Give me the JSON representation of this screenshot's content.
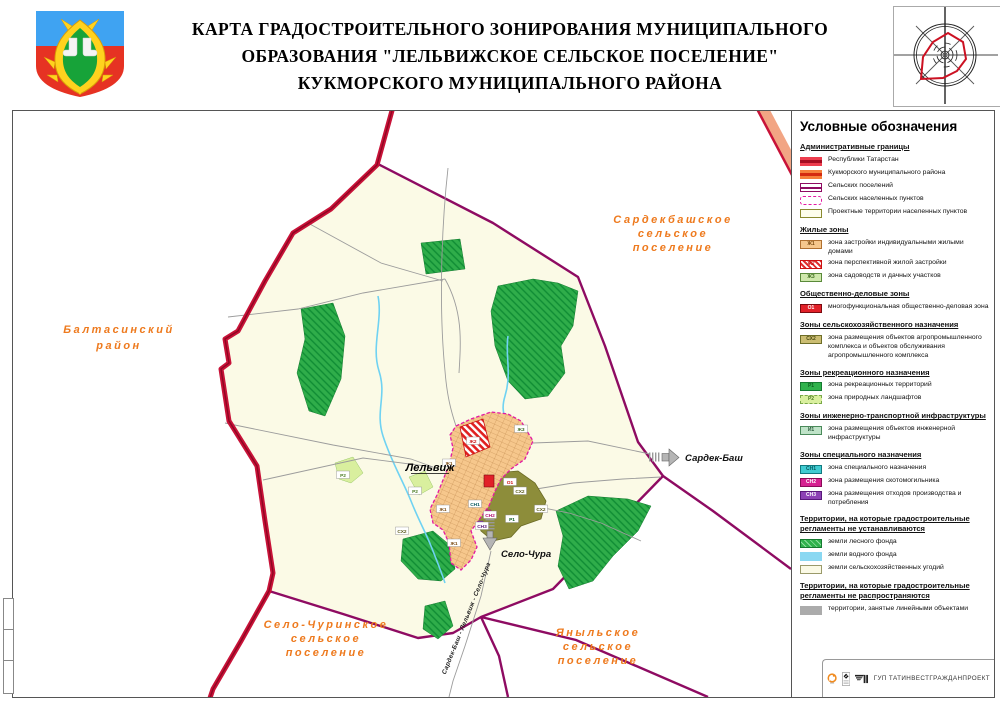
{
  "header": {
    "title_lines": [
      "КАРТА ГРАДОСТРОИТЕЛЬНОГО ЗОНИРОВАНИЯ МУНИЦИПАЛЬНОГО",
      "ОБРАЗОВАНИЯ \"ЛЕЛЬВИЖСКОЕ СЕЛЬСКОЕ ПОСЕЛЕНИЕ\"",
      "КУКМОРСКОГО МУНИЦИПАЛЬНОГО РАЙОНА"
    ]
  },
  "map": {
    "neighbor_labels": {
      "sardekbash": {
        "lines": [
          "Сардекбашское",
          "сельское",
          "поселение"
        ]
      },
      "baltasinsky": {
        "lines": [
          "Балтасинский",
          "район"
        ]
      },
      "selo_churinskoe": {
        "lines": [
          "Село-Чуринское",
          "сельское",
          "поселение"
        ]
      },
      "yanylskoe": {
        "lines": [
          "Яныльское",
          "сельское",
          "поселение"
        ]
      }
    },
    "village_label": "Лельвиж",
    "arrow_labels": {
      "sardek_bash": "Сардек-Баш",
      "selo_chura": "Село-Чура"
    },
    "road_label": "Сардек-Баш - Лельвиж - Село-Чура",
    "zone_codes": {
      "zh1": "Ж1",
      "zh2": "Ж2",
      "zh3": "Ж3",
      "o1": "О1",
      "sh2": "СХ2",
      "r1": "Р1",
      "r2": "Р2",
      "i1": "И1",
      "sn1": "СН1",
      "sn2": "СН2",
      "sn3": "СН3"
    },
    "colors": {
      "neighbor_label": "#ee7a1e",
      "republic_border": "#c81238",
      "settlement_border": "#8e0b62",
      "village_border": "#e319a2",
      "village_fill": "#f6c78c",
      "forest": "#2fad4a",
      "water": "#6fd2f2",
      "farmland": "#fbfae6",
      "agro_zone": "#8d8d3a",
      "business_zone": "#e12028"
    }
  },
  "legend": {
    "title": "Условные обозначения",
    "sections": [
      {
        "title": "Административные границы",
        "items": [
          {
            "swatch": "band",
            "fill": "#ed3d4e",
            "core": "#a50d22",
            "label": "Республики Татарстан"
          },
          {
            "swatch": "band",
            "fill": "#f5803c",
            "core": "#d42a10",
            "label": "Кукморского муниципального района"
          },
          {
            "swatch": "plines",
            "color": "#8e0b62",
            "label": "Сельских поселений"
          },
          {
            "swatch": "dash",
            "color": "#e319a2",
            "label": "Сельских населенных пунктов"
          },
          {
            "swatch": "box",
            "fill": "#fdfdec",
            "border": "#8a8a30",
            "label": "Проектные территории населенных пунктов"
          }
        ]
      },
      {
        "title": "Жилые зоны",
        "items": [
          {
            "swatch": "zone",
            "fill": "#f6c78c",
            "border": "#b07030",
            "code": "Ж1",
            "code_color": "#7a4a10",
            "label": "зона застройки индивидуальными жилыми домами"
          },
          {
            "swatch": "zone",
            "hatch": "#e03030",
            "border": "#cc1111",
            "code": "Ж2",
            "code_color": "#cc1111",
            "label": "зона перспективной жилой застройки"
          },
          {
            "swatch": "zone",
            "fill": "#cfe8ac",
            "border": "#5a8a3a",
            "code": "Ж3",
            "code_color": "#3a6a1a",
            "label": "зона садоводств и дачных участков"
          }
        ]
      },
      {
        "title": "Общественно-деловые зоны",
        "items": [
          {
            "swatch": "zone",
            "fill": "#e12028",
            "border": "#7a0a10",
            "code": "О1",
            "code_color": "#ffffff",
            "label": "многофункциональная общественно-деловая зона"
          }
        ]
      },
      {
        "title": "Зоны сельскохозяйственного назначения",
        "items": [
          {
            "swatch": "zone",
            "fill": "#cbbd72",
            "border": "#6e6e28",
            "code": "СХ2",
            "code_color": "#4a4a10",
            "label": "зона размещения объектов агропромышленного комплекса и объектов обслуживания агропромышленного комплекса"
          }
        ]
      },
      {
        "title": "Зоны рекреационного назначения",
        "items": [
          {
            "swatch": "zone",
            "fill": "#2fb24c",
            "border": "#157a30",
            "code": "Р1",
            "code_color": "#0c5c20",
            "label": "зона рекреационных территорий"
          },
          {
            "swatch": "zone",
            "fill": "#d9ef9e",
            "border": "#7aa848",
            "dashed": true,
            "code": "Р2",
            "code_color": "#4a7a20",
            "label": "зона природных ландшафтов"
          }
        ]
      },
      {
        "title": "Зоны инженерно-транспортной инфраструктуры",
        "items": [
          {
            "swatch": "zone",
            "fill": "#bfe3c8",
            "border": "#4a8a5a",
            "code": "И1",
            "code_color": "#2a5a3a",
            "label": "зона размещения объектов инженерной инфраструктуры"
          }
        ]
      },
      {
        "title": "Зоны специального назначения",
        "items": [
          {
            "swatch": "zone",
            "fill": "#40cbd1",
            "border": "#117a80",
            "code": "СН1",
            "code_color": "#075a60",
            "label": "зона специального назначения"
          },
          {
            "swatch": "zone",
            "fill": "#d62191",
            "border": "#8a0a58",
            "code": "СН2",
            "code_color": "#ffffff",
            "label": "зона размещения скотомогильника"
          },
          {
            "swatch": "zone",
            "fill": "#8d41b5",
            "border": "#58187a",
            "code": "СН3",
            "code_color": "#ffffff",
            "label": "зона размещения отходов производства и потребления"
          }
        ]
      },
      {
        "title": "Территории, на которые градостроительные регламенты не устанавливаются",
        "items": [
          {
            "swatch": "zone",
            "fill": "#2fb24c",
            "stripe": "#8fe0a0",
            "border": "#157a30",
            "label": "земли лесного фонда"
          },
          {
            "swatch": "plain",
            "fill": "#8ad8f2",
            "label": "земли водного фонда"
          },
          {
            "swatch": "box",
            "fill": "#fbfae6",
            "border": "#9a9a6a",
            "label": "земли сельскохозяйственных угодий"
          }
        ]
      },
      {
        "title": "Территории, на которые градостроительные регламенты не распространяются",
        "items": [
          {
            "swatch": "plain",
            "fill": "#ababab",
            "label": "территории, занятые линейными объектами"
          }
        ]
      }
    ]
  },
  "footer": {
    "org": "ГУП  ТАТИНВЕСТГРАЖДАНПРОЕКТ"
  }
}
